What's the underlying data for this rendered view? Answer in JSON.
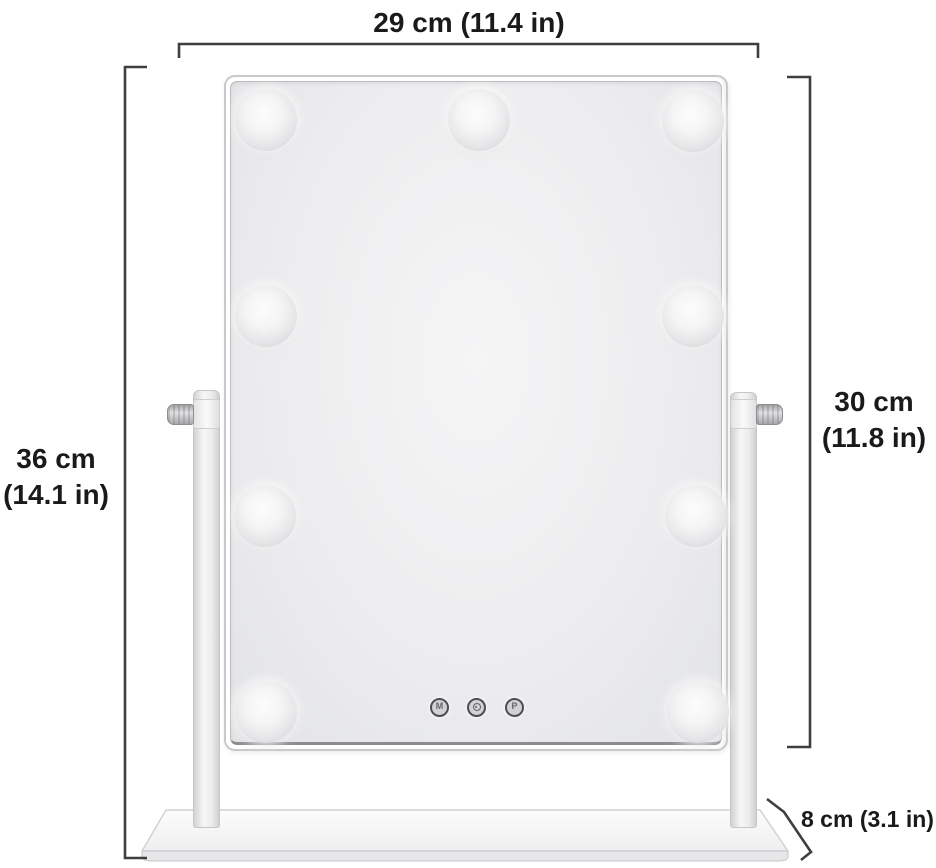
{
  "diagram": {
    "product": "lighted-vanity-mirror",
    "dimensions": {
      "width": {
        "label": "29 cm (11.4 in)"
      },
      "total_height": {
        "line1": "36 cm",
        "line2": "(14.1 in)"
      },
      "mirror_height": {
        "line1": "30 cm",
        "line2": "(11.8 in)"
      },
      "base_depth": {
        "label": "8 cm (3.1 in)"
      }
    },
    "mirror": {
      "bulb_count": 9,
      "buttons": {
        "left": "M",
        "middle_icon": "power",
        "right": "P"
      }
    },
    "colors": {
      "background": "#ffffff",
      "dimension_line": "#3f3f3f",
      "label_text": "#1a1a1a",
      "frame_border": "#c9c9cb",
      "glass": "#ececee",
      "metal": "#f0f0f0"
    }
  }
}
